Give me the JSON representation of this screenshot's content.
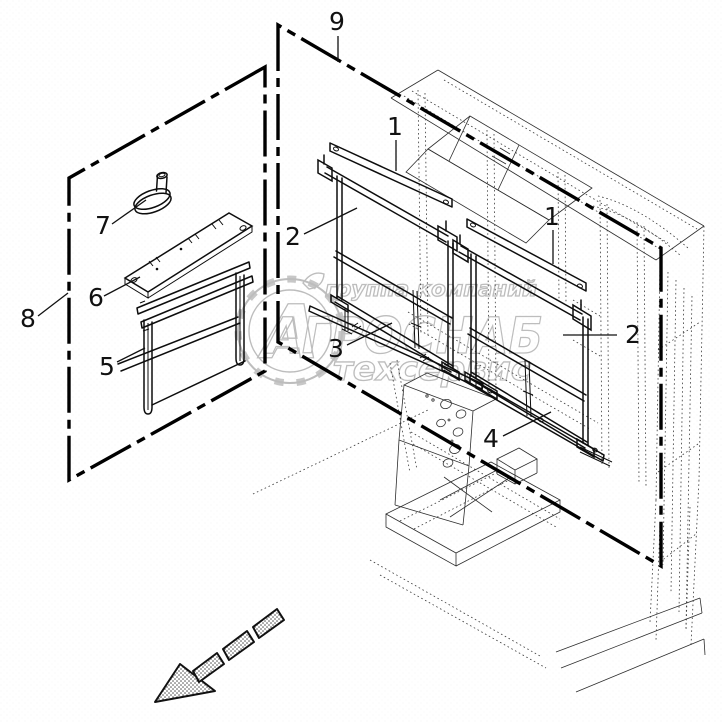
{
  "diagram": {
    "type": "exploded-parts-diagram",
    "background_color": "#ffffff",
    "ink_color": "#0d0d0d",
    "thin_line_color": "#2d2d2d",
    "border_style": "dash-dot",
    "callouts": [
      {
        "id": "1-left",
        "label": "1"
      },
      {
        "id": "1-right",
        "label": "1"
      },
      {
        "id": "2-left",
        "label": "2"
      },
      {
        "id": "2-right",
        "label": "2"
      },
      {
        "id": "3",
        "label": "3"
      },
      {
        "id": "4",
        "label": "4"
      },
      {
        "id": "5",
        "label": "5"
      },
      {
        "id": "6",
        "label": "6"
      },
      {
        "id": "7",
        "label": "7"
      },
      {
        "id": "8",
        "label": "8"
      },
      {
        "id": "9",
        "label": "9"
      }
    ]
  },
  "watermark": {
    "color": "#bdbdbd",
    "group_line": "группа компаний",
    "brand": "АГРОСНАБ",
    "service_line": "техсервис",
    "logo_letter": "А"
  }
}
